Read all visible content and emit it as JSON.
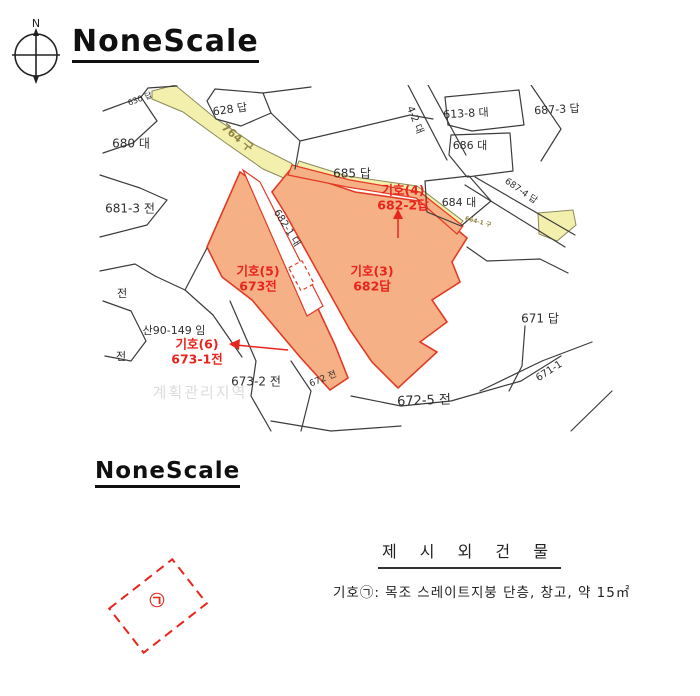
{
  "colors": {
    "parcel_fill": "#f6b085",
    "parcel_border": "#e23b25",
    "road_fill": "#f3f0ae",
    "road_edge": "#8a8a5a",
    "road_text": "#8f8445",
    "red_label": "#e8241d",
    "line": "#3c3c3c",
    "watermark": "#dcdcdc"
  },
  "header": {
    "compass_label": "N",
    "title": "NoneScale"
  },
  "map": {
    "parcel_labels": [
      {
        "text": "630 답",
        "x": 45,
        "y": 14,
        "rot": -20,
        "size": 8
      },
      {
        "text": "680 대",
        "x": 36,
        "y": 59,
        "rot": 0,
        "size": 12
      },
      {
        "text": "628 답",
        "x": 135,
        "y": 25,
        "rot": -8,
        "size": 11
      },
      {
        "text": "4-2 대",
        "x": 320,
        "y": 35,
        "rot": 68,
        "size": 10
      },
      {
        "text": "613-8 대",
        "x": 371,
        "y": 29,
        "rot": -3,
        "size": 11
      },
      {
        "text": "687-3 답",
        "x": 462,
        "y": 25,
        "rot": -3,
        "size": 11
      },
      {
        "text": "686 대",
        "x": 375,
        "y": 61,
        "rot": 0,
        "size": 11
      },
      {
        "text": "687-4 답",
        "x": 426,
        "y": 106,
        "rot": 35,
        "size": 9
      },
      {
        "text": "685 답",
        "x": 257,
        "y": 89,
        "rot": 0,
        "size": 12
      },
      {
        "text": "684 대",
        "x": 364,
        "y": 118,
        "rot": 0,
        "size": 11
      },
      {
        "text": "681-3 전",
        "x": 35,
        "y": 124,
        "rot": 0,
        "size": 12
      },
      {
        "text": "682-1 대",
        "x": 192,
        "y": 143,
        "rot": 58,
        "size": 10
      },
      {
        "text": "산90-149 임",
        "x": 79,
        "y": 246,
        "rot": 0,
        "size": 11
      },
      {
        "text": "673-2 전",
        "x": 161,
        "y": 297,
        "rot": 0,
        "size": 12
      },
      {
        "text": "672 전",
        "x": 228,
        "y": 294,
        "rot": -22,
        "size": 9
      },
      {
        "text": "672-5 전",
        "x": 329,
        "y": 316,
        "rot": -2,
        "size": 13
      },
      {
        "text": "671 답",
        "x": 445,
        "y": 234,
        "rot": 0,
        "size": 12
      },
      {
        "text": "671-1",
        "x": 454,
        "y": 286,
        "rot": -33,
        "size": 10
      },
      {
        "text": "전",
        "x": 27,
        "y": 209,
        "rot": 0,
        "size": 11
      },
      {
        "text": "전",
        "x": 26,
        "y": 272,
        "rot": 0,
        "size": 11
      }
    ],
    "road_labels": [
      {
        "text": "764 구",
        "x": 142,
        "y": 53,
        "rot": 40,
        "size": 11
      },
      {
        "text": "664-1 구",
        "x": 383,
        "y": 137,
        "rot": 15,
        "size": 6
      }
    ],
    "red_labels": [
      {
        "lines": [
          "기호(4)",
          "682-2답"
        ],
        "x": 308,
        "y": 106
      },
      {
        "lines": [
          "기호(5)",
          "673전"
        ],
        "x": 163,
        "y": 187
      },
      {
        "lines": [
          "기호(3)",
          "682답"
        ],
        "x": 277,
        "y": 187
      },
      {
        "lines": [
          "기호(6)",
          "673-1전"
        ],
        "x": 102,
        "y": 260
      }
    ],
    "watermark": "계획관리지역"
  },
  "section2": {
    "title": "NoneScale"
  },
  "sketch": {
    "symbol": "㉠"
  },
  "legend": {
    "title": "제 시 외 건 물",
    "item": "기호㉠: 목조 스레이트지붕 단층, 창고, 약 15㎡"
  }
}
